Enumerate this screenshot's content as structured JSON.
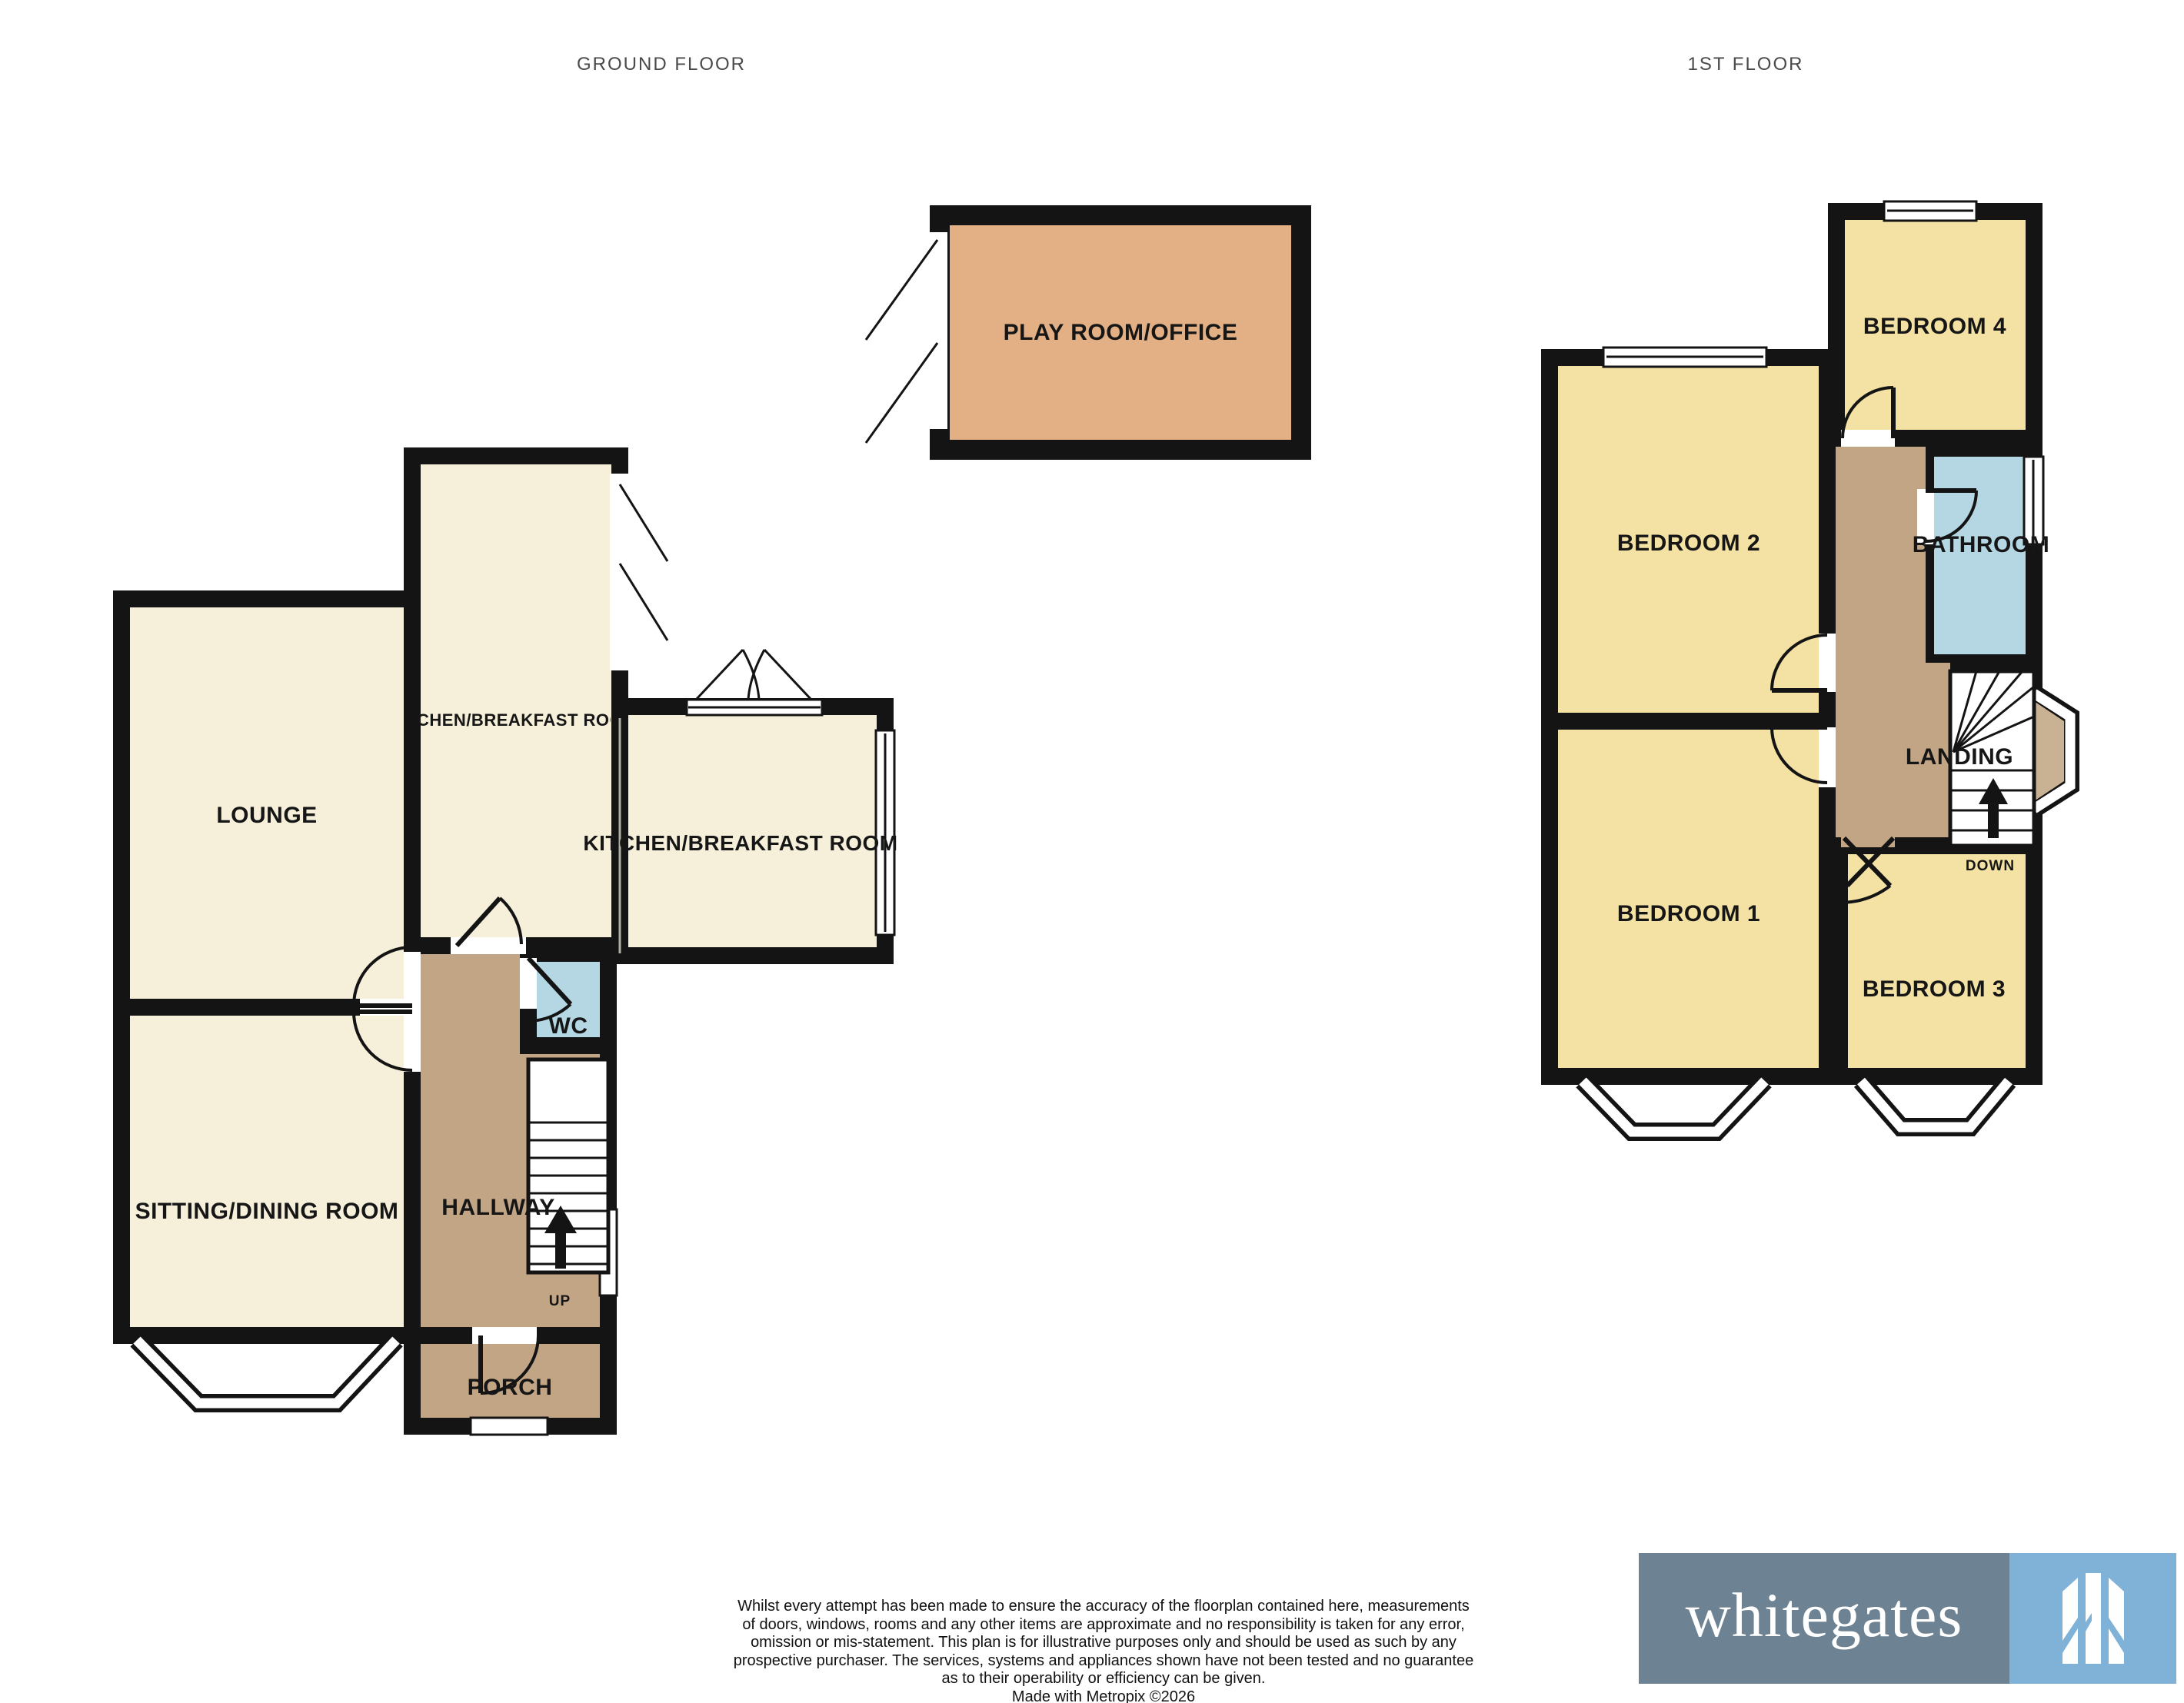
{
  "floor_titles": {
    "ground": "GROUND FLOOR",
    "first": "1ST FLOOR"
  },
  "ground_floor": {
    "rooms": {
      "lounge": "LOUNGE",
      "sitting_dining": "SITTING/DINING ROOM",
      "kitchen_breakfast_wing": "KITCHEN/BREAKFAST ROOM",
      "kitchen_breakfast": "KITCHEN/BREAKFAST ROOM",
      "hallway": "HALLWAY",
      "wc": "WC",
      "porch": "PORCH",
      "play_room_office": "PLAY ROOM/OFFICE"
    },
    "stairs_label": "UP"
  },
  "first_floor": {
    "rooms": {
      "bedroom_1": "BEDROOM 1",
      "bedroom_2": "BEDROOM 2",
      "bedroom_3": "BEDROOM 3",
      "bedroom_4": "BEDROOM 4",
      "bathroom": "BATHROOM",
      "landing": "LANDING"
    },
    "stairs_label": "DOWN"
  },
  "disclaimer": {
    "lines": [
      "Whilst every attempt has been made to ensure the accuracy of the floorplan contained here, measurements",
      "of doors, windows, rooms and any other items are approximate and no responsibility is taken for any error,",
      "omission or mis-statement. This plan is for illustrative purposes only and should be used as such by any",
      "prospective purchaser. The services, systems and appliances shown have not been tested and no guarantee",
      "as to their operability or efficiency can be given.",
      "Made with Metropix ©2026"
    ]
  },
  "logo": {
    "brand": "whitegates",
    "icon": "gate-icon"
  },
  "colors": {
    "wall": "#141414",
    "room_cream": "#f6f0da",
    "room_yellow": "#f3e2a3",
    "circulation_tan": "#c2a585",
    "wet_room_blue": "#b4d7e3",
    "play_room_orange": "#e2b084",
    "bay_tan": "#c9b294",
    "logo_slate": "#6d8292",
    "logo_blue": "#80b2d8",
    "title_text": "#4a4a4a"
  }
}
